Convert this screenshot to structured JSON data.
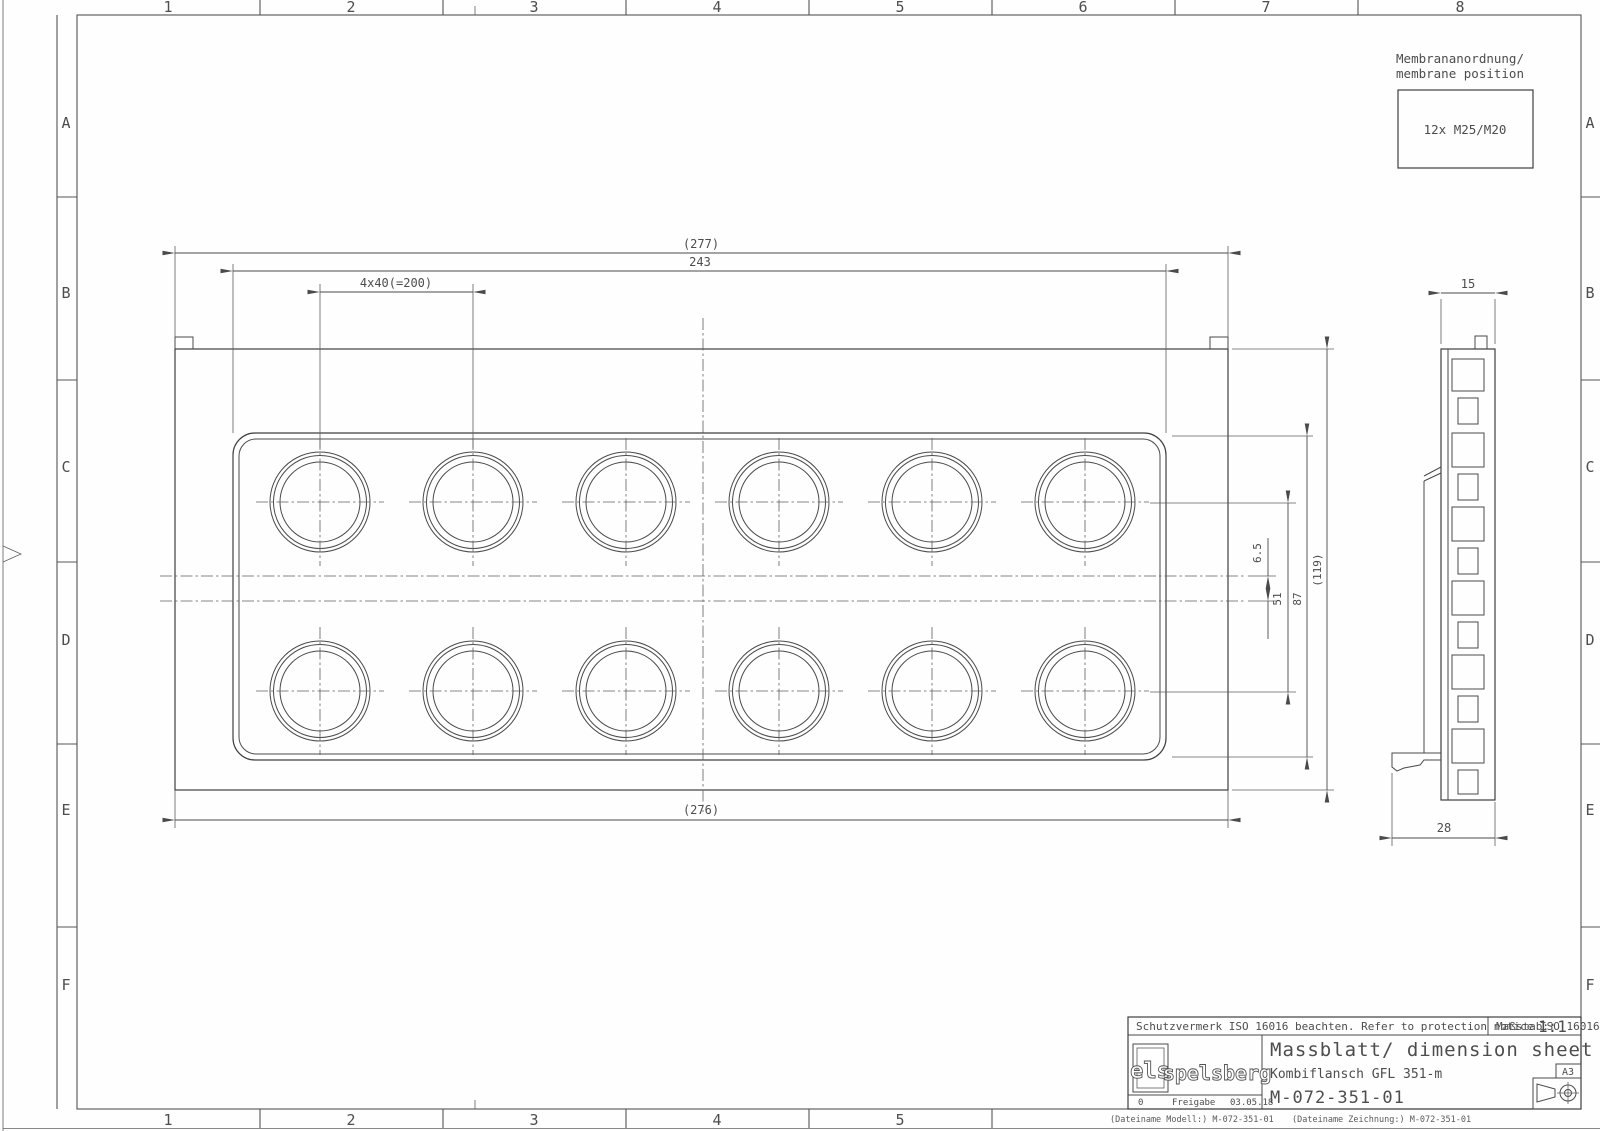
{
  "sheet": {
    "columns": [
      "1",
      "2",
      "3",
      "4",
      "5",
      "6",
      "7",
      "8"
    ],
    "rows": [
      "A",
      "B",
      "C",
      "D",
      "E",
      "F"
    ]
  },
  "note": {
    "line1": "Membrananordnung/",
    "line2": "membrane position",
    "box_label": "12x M25/M20"
  },
  "dims": {
    "overall_width_ref": "(277)",
    "field_width": "243",
    "pitch": "4x40(=200)",
    "center_offset": "6.5",
    "row_spacing": "51",
    "field_height": "87",
    "overall_height_ref": "(119)",
    "bottom_width_ref": "(276)",
    "side_depth": "15",
    "side_total_depth": "28"
  },
  "title_block": {
    "protection_notice": "Schutzvermerk ISO 16016 beachten. Refer to protection notice ISO 16016.",
    "scale_label": "Maßstab:",
    "scale_value": "1:1",
    "logo_mark": "els",
    "logo_name": "spelsberg",
    "revision": "0",
    "release_label": "Freigabe",
    "release_date": "03.05.18",
    "doc_title": "Massblatt/ dimension sheet",
    "part_name": "Kombiflansch GFL 351-m",
    "drawing_number": "M-072-351-01",
    "format": "A3",
    "file_model": "(Dateiname Modell:) M-072-351-01",
    "file_drawing": "(Dateiname Zeichnung:) M-072-351-01"
  },
  "colors": {
    "line": "#4a4a4a",
    "text": "#4d4d4d",
    "background": "#fefefe"
  }
}
